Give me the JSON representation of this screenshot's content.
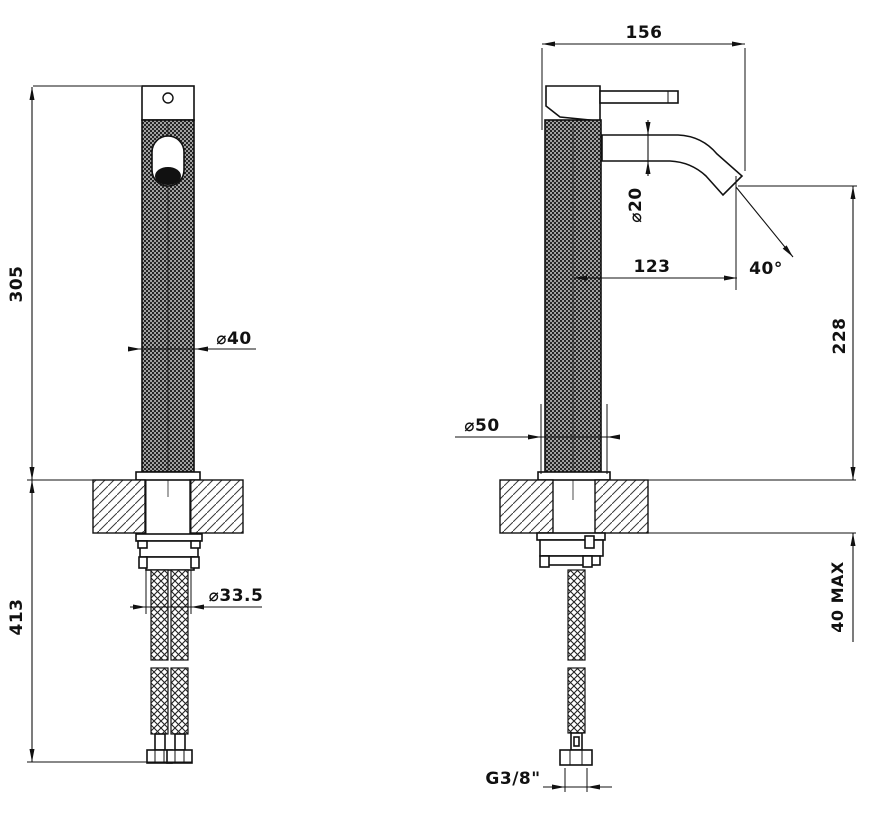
{
  "front_view": {
    "total_height": "305",
    "below_deck_height": "413",
    "body_diameter": "⌀40",
    "shank_diameter": "⌀33.5"
  },
  "side_view": {
    "depth": "156",
    "spout_tube_diameter": "⌀20",
    "spout_reach": "123",
    "spout_angle": "40°",
    "spout_height": "228",
    "base_diameter": "⌀50",
    "counter_thickness": "40 MAX",
    "hose_connection": "G3/8\""
  }
}
